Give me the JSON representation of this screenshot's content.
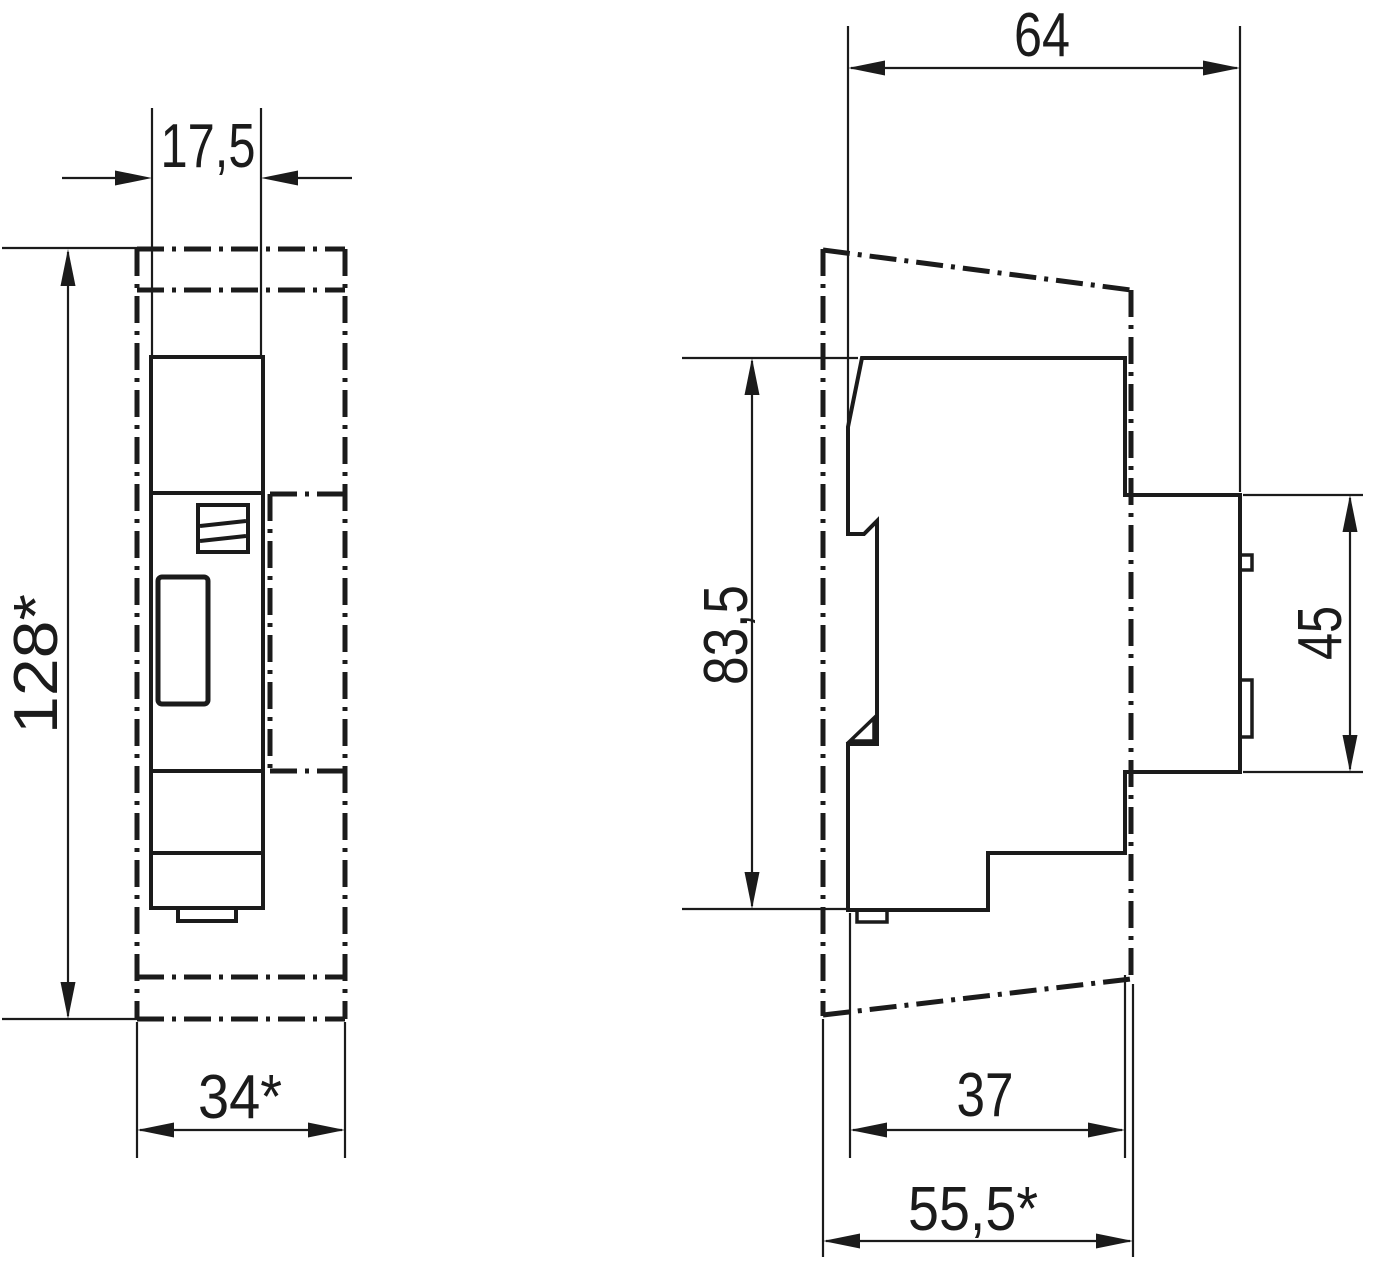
{
  "labels": {
    "front_width": "17,5",
    "front_height": "128*",
    "front_envelope_width": "34*",
    "side_depth": "64",
    "side_body_height": "83,5",
    "side_panel_height": "45",
    "side_lower_depth": "37",
    "side_total_depth": "55,5*"
  },
  "colors": {
    "line": "#1b1b1b",
    "background": "#ffffff"
  }
}
